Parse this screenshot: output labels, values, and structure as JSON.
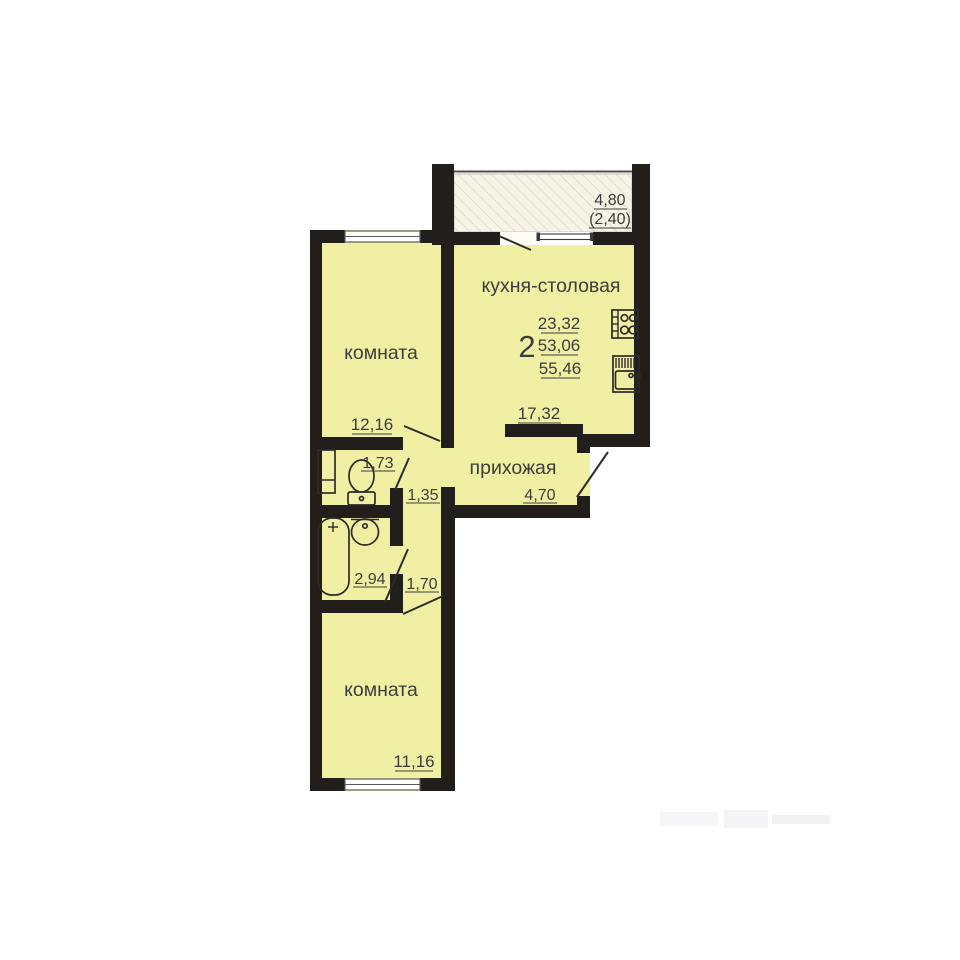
{
  "rooms": {
    "kitchen": {
      "label": "кухня-столовая",
      "area": "17,32"
    },
    "room_top": {
      "label": "комната",
      "area": "12,16"
    },
    "room_bottom": {
      "label": "комната",
      "area": "11,16"
    },
    "hall": {
      "label": "прихожая",
      "area": "4,70"
    },
    "wc": {
      "area": "1,73"
    },
    "bathroom": {
      "area": "2,94"
    },
    "corridor_upper": {
      "area": "1,35"
    },
    "corridor_lower": {
      "area": "1,70"
    },
    "balcony": {
      "length": "4,80",
      "reduced": "(2,40)"
    }
  },
  "summary": {
    "rooms_count": "2",
    "figures": [
      "23,32",
      "53,06",
      "55,46"
    ]
  },
  "colors": {
    "wall": "#221e1c",
    "room_fill": "#f0efa4",
    "balcony_fill": "#f6f3e7",
    "balcony_hatch": "#d9d2bd",
    "text": "#3d3d3d"
  }
}
